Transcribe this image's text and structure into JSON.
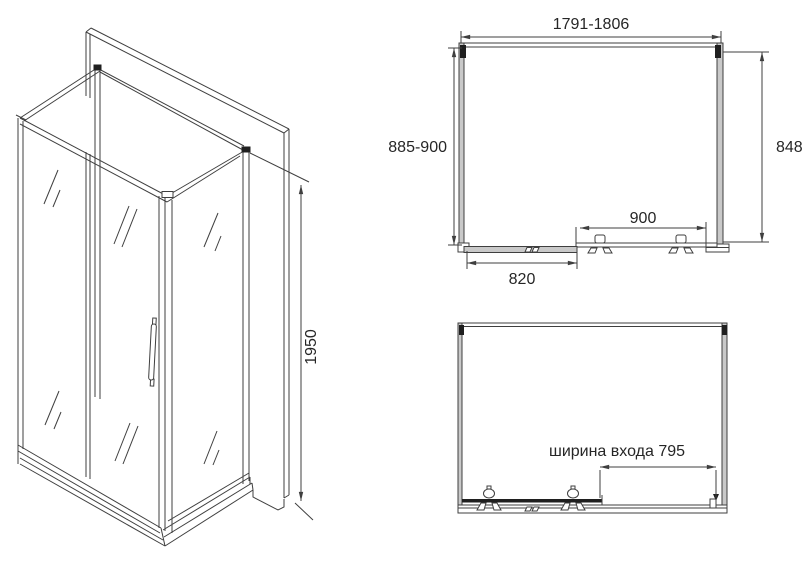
{
  "colors": {
    "background": "#ffffff",
    "line": "#3f3f3f",
    "profile_fill": "#c9c9c9",
    "bracket_fill": "#1f1f1f",
    "text": "#262626"
  },
  "views": {
    "isometric": {
      "height_dim": "1950"
    },
    "plan": {
      "width_dim": "1791-1806",
      "depth_dim": "885-900",
      "right_side_dim": "848",
      "fixed_glass_dim": "900",
      "door_glass_dim": "820"
    },
    "front_open": {
      "entrance_dim": "ширина входа 795"
    }
  }
}
